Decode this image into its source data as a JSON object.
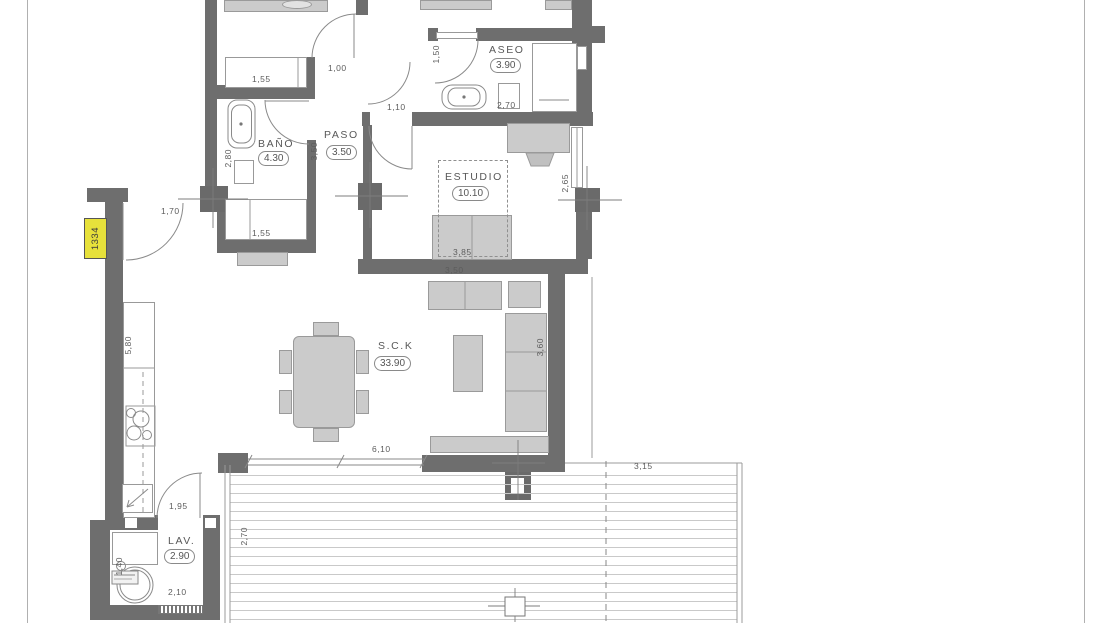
{
  "document": {
    "type": "apartment-floor-plan",
    "unit_tag": "1334",
    "colors": {
      "wall": "#6e6e6e",
      "furniture": "#cbcbcb",
      "furniture_border": "#9a9a9a",
      "linework": "#8a8a8a",
      "text": "#565656",
      "tag_background": "#e7e13b",
      "deck_line": "#c9c9c9"
    }
  },
  "plan": {
    "rooms": [
      {
        "id": "banio",
        "name": "BAÑO",
        "area": "4.30"
      },
      {
        "id": "paso",
        "name": "PASO",
        "area": "3.50"
      },
      {
        "id": "aseo",
        "name": "ASEO",
        "area": "3.90"
      },
      {
        "id": "estudio",
        "name": "ESTUDIO",
        "area": "10.10"
      },
      {
        "id": "sck",
        "name": "S.C.K",
        "area": "33.90"
      },
      {
        "id": "lav",
        "name": "LAV.",
        "area": "2.90"
      }
    ],
    "dimensions": [
      {
        "text": "1,55"
      },
      {
        "text": "1,00"
      },
      {
        "text": "1,50"
      },
      {
        "text": "1,10"
      },
      {
        "text": "2,70"
      },
      {
        "text": "3,50"
      },
      {
        "text": "2,80"
      },
      {
        "text": "1,55"
      },
      {
        "text": "1,70"
      },
      {
        "text": "2,65"
      },
      {
        "text": "3,85"
      },
      {
        "text": "3,50"
      },
      {
        "text": "3,60"
      },
      {
        "text": "5,80"
      },
      {
        "text": "6,10"
      },
      {
        "text": "1,95"
      },
      {
        "text": "1,40"
      },
      {
        "text": "2,10"
      },
      {
        "text": "2,70"
      },
      {
        "text": "3,15"
      }
    ]
  }
}
